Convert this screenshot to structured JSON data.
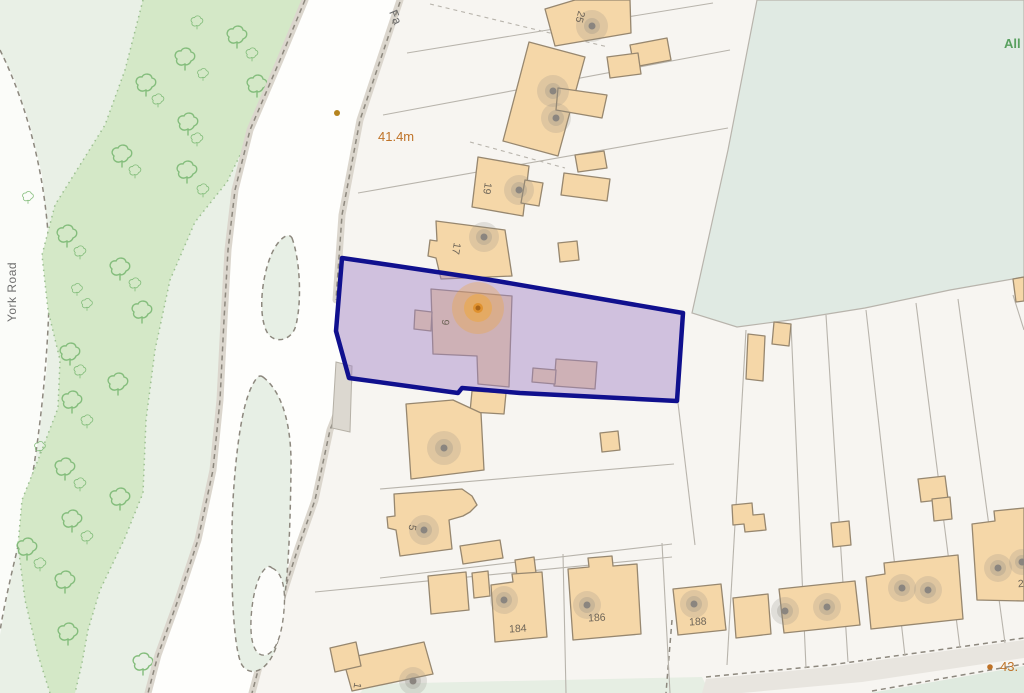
{
  "map": {
    "labels": {
      "york_road": "York Road",
      "road_top_partial": "Fa",
      "area_top_right_partial": "All",
      "spot_height_upper": "41.4m",
      "spot_height_lower": "43.",
      "house_25": "25",
      "house_19": "19",
      "house_17": "17",
      "house_9": "9",
      "house_5": "5",
      "house_1": "1",
      "house_184": "184",
      "house_186": "186",
      "house_188": "188",
      "house_2_partial": "2"
    },
    "colors": {
      "plot_fill": "rgba(160,130,200,0.45)",
      "plot_border": "#10108e",
      "building": "#f5d7a8",
      "building_outline": "#97876f",
      "woodland": "#d4e8c7",
      "verge": "#e9f0e6",
      "field": "#e0eae3",
      "road_casing": "#dbd6cd",
      "marker_orange": "#e0922f",
      "label_orange": "#bf7328",
      "label_green": "#58a05e",
      "tree_outline": "#84bd7c"
    }
  }
}
